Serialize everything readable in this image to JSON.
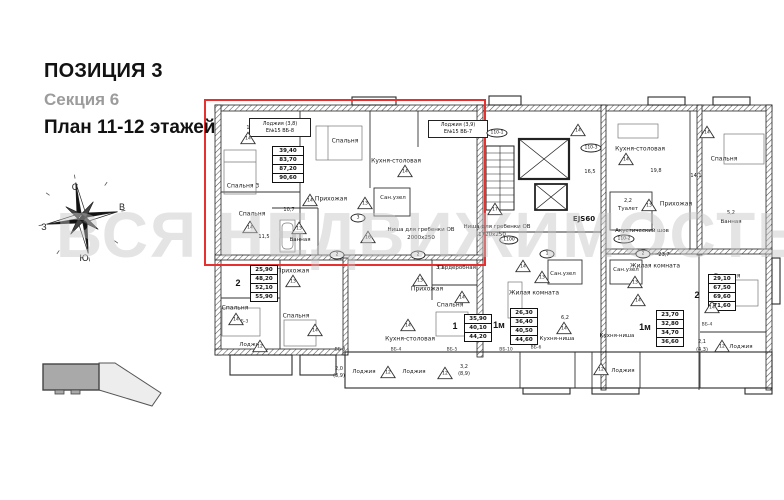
{
  "header": {
    "position": "ПОЗИЦИЯ 3",
    "section": "Секция 6",
    "plan": "План 11-12 этажей"
  },
  "compass": {
    "north": "С",
    "east": "В",
    "west": "З",
    "south": "Ю"
  },
  "watermark": {
    "text": "ВСЯ НЕДВИЖИМОСТЬ"
  },
  "colors": {
    "highlight": "#e6312e",
    "walls": "#222222",
    "muted": "#9c9c9c"
  },
  "plan": {
    "unit_boxes": [
      {
        "rows": [
          "Лоджия  (3,8)",
          "Е№15  ВБ-8"
        ],
        "x": 249,
        "y": 118,
        "w": 60,
        "h": 17
      },
      {
        "rows": [
          "Лоджия  (3,9)",
          "Е№15  ВБ-7"
        ],
        "x": 428,
        "y": 120,
        "w": 58,
        "h": 16
      }
    ],
    "tables": [
      {
        "rows": [
          "39,40",
          "83,70",
          "87,20",
          "90,60"
        ],
        "x": 272,
        "y": 146,
        "w": 30,
        "unit": "",
        "ux": 0,
        "uy": 0
      },
      {
        "rows": [
          "25,90",
          "48,20",
          "52,10",
          "55,90"
        ],
        "x": 250,
        "y": 265,
        "w": 26,
        "unit": "2",
        "ux": 238,
        "uy": 283
      },
      {
        "rows": [
          "35,90",
          "40,10",
          "44,20"
        ],
        "x": 464,
        "y": 314,
        "w": 26,
        "unit": "1",
        "ux": 455,
        "uy": 326
      },
      {
        "rows": [
          "26,30",
          "36,40",
          "40,50",
          "44,60"
        ],
        "x": 510,
        "y": 308,
        "w": 26,
        "unit": "1м",
        "ux": 499,
        "uy": 325
      },
      {
        "rows": [
          "23,70",
          "32,80",
          "34,70",
          "36,60"
        ],
        "x": 656,
        "y": 310,
        "w": 26,
        "unit": "1м",
        "ux": 645,
        "uy": 327
      },
      {
        "rows": [
          "29,10",
          "67,50",
          "69,60",
          "71,60"
        ],
        "x": 708,
        "y": 274,
        "w": 26,
        "unit": "2",
        "ux": 697,
        "uy": 295
      }
    ],
    "labels": [
      {
        "text": "Спальня 3",
        "x": 243,
        "y": 186
      },
      {
        "text": "15,5",
        "x": 252,
        "y": 128,
        "cls": "dim"
      },
      {
        "text": "Спальня",
        "x": 345,
        "y": 141
      },
      {
        "text": "Кухня-столовая",
        "x": 396,
        "y": 161
      },
      {
        "text": "Прихожая",
        "x": 331,
        "y": 199
      },
      {
        "text": "Сан.узел",
        "x": 393,
        "y": 198,
        "cls": "sm"
      },
      {
        "text": "Спальня",
        "x": 252,
        "y": 214
      },
      {
        "text": "11,5",
        "x": 264,
        "y": 237,
        "cls": "dim"
      },
      {
        "text": "10,7",
        "x": 289,
        "y": 210,
        "cls": "dim"
      },
      {
        "text": "Ванная",
        "x": 300,
        "y": 240,
        "cls": "sm"
      },
      {
        "text": "Ниша для гребенки ОВ",
        "x": 421,
        "y": 230,
        "cls": "note"
      },
      {
        "text": "2000x250",
        "x": 421,
        "y": 238,
        "cls": "note"
      },
      {
        "text": "Ниша для гребенки ОВ",
        "x": 497,
        "y": 227,
        "cls": "note"
      },
      {
        "text": "1720x250",
        "x": 492,
        "y": 235,
        "cls": "note"
      },
      {
        "text": "EJS60",
        "x": 584,
        "y": 219,
        "cls": "note2"
      },
      {
        "text": "Акустический шов",
        "x": 642,
        "y": 231,
        "cls": "note"
      },
      {
        "text": "Кухня-столовая",
        "x": 640,
        "y": 149
      },
      {
        "text": "19,8",
        "x": 656,
        "y": 171,
        "cls": "dim"
      },
      {
        "text": "Спальня",
        "x": 724,
        "y": 159
      },
      {
        "text": "14,1",
        "x": 696,
        "y": 176,
        "cls": "dim"
      },
      {
        "text": "16,5",
        "x": 590,
        "y": 172,
        "cls": "dim"
      },
      {
        "text": "Прихожая",
        "x": 676,
        "y": 204
      },
      {
        "text": "Туалет",
        "x": 628,
        "y": 209,
        "cls": "sm"
      },
      {
        "text": "2,2",
        "x": 628,
        "y": 201,
        "cls": "dim"
      },
      {
        "text": "Ванная",
        "x": 731,
        "y": 222,
        "cls": "sm"
      },
      {
        "text": "5,2",
        "x": 731,
        "y": 213,
        "cls": "dim"
      },
      {
        "text": "Прихожая",
        "x": 293,
        "y": 271
      },
      {
        "text": "Спальня",
        "x": 235,
        "y": 308
      },
      {
        "text": "Спальня",
        "x": 296,
        "y": 316
      },
      {
        "text": "Лоджия",
        "x": 251,
        "y": 345,
        "cls": "sm"
      },
      {
        "text": "ВБ-3",
        "x": 243,
        "y": 322,
        "cls": "tiny"
      },
      {
        "text": "Гардеробная",
        "x": 457,
        "y": 268,
        "cls": "sm"
      },
      {
        "text": "3,1",
        "x": 440,
        "y": 268,
        "cls": "dim"
      },
      {
        "text": "Прихожая",
        "x": 427,
        "y": 289
      },
      {
        "text": "Спальня",
        "x": 450,
        "y": 305
      },
      {
        "text": "Кухня-столовая",
        "x": 410,
        "y": 339
      },
      {
        "text": "Сан.узел",
        "x": 563,
        "y": 274,
        "cls": "sm"
      },
      {
        "text": "Жилая комната",
        "x": 534,
        "y": 293
      },
      {
        "text": "6,2",
        "x": 565,
        "y": 318,
        "cls": "dim"
      },
      {
        "text": "Кухня-ниша",
        "x": 557,
        "y": 339,
        "cls": "sm"
      },
      {
        "text": "Сан.узел",
        "x": 626,
        "y": 270,
        "cls": "sm"
      },
      {
        "text": "Жилая комната",
        "x": 655,
        "y": 266
      },
      {
        "text": "23,7",
        "x": 664,
        "y": 255,
        "cls": "dim"
      },
      {
        "text": "Кухня-ниша",
        "x": 617,
        "y": 336,
        "cls": "sm"
      },
      {
        "text": "Спальня",
        "x": 727,
        "y": 276
      },
      {
        "text": "Лоджия",
        "x": 741,
        "y": 347,
        "cls": "sm"
      },
      {
        "text": "2,1",
        "x": 702,
        "y": 342,
        "cls": "dim"
      },
      {
        "text": "(4,3)",
        "x": 702,
        "y": 350,
        "cls": "dim"
      },
      {
        "text": "Лоджия",
        "x": 364,
        "y": 372,
        "cls": "sm"
      },
      {
        "text": "2,0",
        "x": 339,
        "y": 369,
        "cls": "dim"
      },
      {
        "text": "(3,9)",
        "x": 339,
        "y": 376,
        "cls": "dim"
      },
      {
        "text": "Лоджия",
        "x": 414,
        "y": 372,
        "cls": "sm"
      },
      {
        "text": "3,2",
        "x": 464,
        "y": 367,
        "cls": "dim"
      },
      {
        "text": "(8,9)",
        "x": 464,
        "y": 374,
        "cls": "dim"
      },
      {
        "text": "Лоджия",
        "x": 623,
        "y": 371,
        "cls": "sm"
      },
      {
        "text": "ВБ-3",
        "x": 340,
        "y": 350,
        "cls": "tiny"
      },
      {
        "text": "ВБ-4",
        "x": 396,
        "y": 350,
        "cls": "tiny"
      },
      {
        "text": "ВБ-5",
        "x": 452,
        "y": 350,
        "cls": "tiny"
      },
      {
        "text": "ВБ-10",
        "x": 506,
        "y": 350,
        "cls": "tiny"
      },
      {
        "text": "ВБ-6",
        "x": 536,
        "y": 348,
        "cls": "tiny"
      },
      {
        "text": "ВБ-4",
        "x": 707,
        "y": 325,
        "cls": "tiny"
      }
    ],
    "markers": [
      {
        "shape": "triangle",
        "text": "14",
        "x": 248,
        "y": 138
      },
      {
        "shape": "triangle",
        "text": "14",
        "x": 405,
        "y": 171
      },
      {
        "shape": "triangle",
        "text": "14",
        "x": 310,
        "y": 200
      },
      {
        "shape": "triangle",
        "text": "14",
        "x": 250,
        "y": 227
      },
      {
        "shape": "triangle",
        "text": "13",
        "x": 299,
        "y": 228
      },
      {
        "shape": "triangle",
        "text": "16",
        "x": 368,
        "y": 237
      },
      {
        "shape": "triangle",
        "text": "13",
        "x": 365,
        "y": 203
      },
      {
        "shape": "triangle",
        "text": "17",
        "x": 495,
        "y": 209
      },
      {
        "shape": "triangle",
        "text": "14",
        "x": 578,
        "y": 130
      },
      {
        "shape": "triangle",
        "text": "14",
        "x": 707,
        "y": 132
      },
      {
        "shape": "triangle",
        "text": "14",
        "x": 626,
        "y": 159
      },
      {
        "shape": "triangle",
        "text": "13",
        "x": 649,
        "y": 205
      },
      {
        "shape": "triangle",
        "text": "13",
        "x": 293,
        "y": 281
      },
      {
        "shape": "triangle",
        "text": "14",
        "x": 236,
        "y": 319
      },
      {
        "shape": "triangle",
        "text": "14",
        "x": 315,
        "y": 330
      },
      {
        "shape": "triangle",
        "text": "12",
        "x": 260,
        "y": 346
      },
      {
        "shape": "triangle",
        "text": "13",
        "x": 420,
        "y": 280
      },
      {
        "shape": "triangle",
        "text": "14",
        "x": 462,
        "y": 297
      },
      {
        "shape": "triangle",
        "text": "14",
        "x": 408,
        "y": 325
      },
      {
        "shape": "triangle",
        "text": "14",
        "x": 523,
        "y": 266
      },
      {
        "shape": "triangle",
        "text": "13",
        "x": 542,
        "y": 277
      },
      {
        "shape": "triangle",
        "text": "14",
        "x": 564,
        "y": 328
      },
      {
        "shape": "triangle",
        "text": "12",
        "x": 388,
        "y": 372
      },
      {
        "shape": "triangle",
        "text": "12",
        "x": 445,
        "y": 373
      },
      {
        "shape": "triangle",
        "text": "13",
        "x": 635,
        "y": 282
      },
      {
        "shape": "triangle",
        "text": "14",
        "x": 638,
        "y": 300
      },
      {
        "shape": "triangle",
        "text": "12",
        "x": 601,
        "y": 369
      },
      {
        "shape": "triangle",
        "text": "14",
        "x": 712,
        "y": 307
      },
      {
        "shape": "triangle",
        "text": "12",
        "x": 722,
        "y": 346
      }
    ],
    "circles": [
      {
        "text": "110-1",
        "x": 497,
        "y": 133
      },
      {
        "text": "110-3",
        "x": 591,
        "y": 148
      },
      {
        "text": "1100",
        "x": 509,
        "y": 240
      },
      {
        "text": "110-2",
        "x": 624,
        "y": 239
      },
      {
        "text": "2",
        "x": 337,
        "y": 255
      },
      {
        "text": "3",
        "x": 358,
        "y": 218
      },
      {
        "text": "2",
        "x": 418,
        "y": 255
      },
      {
        "text": "1",
        "x": 547,
        "y": 254
      },
      {
        "text": "2",
        "x": 643,
        "y": 254
      }
    ]
  }
}
